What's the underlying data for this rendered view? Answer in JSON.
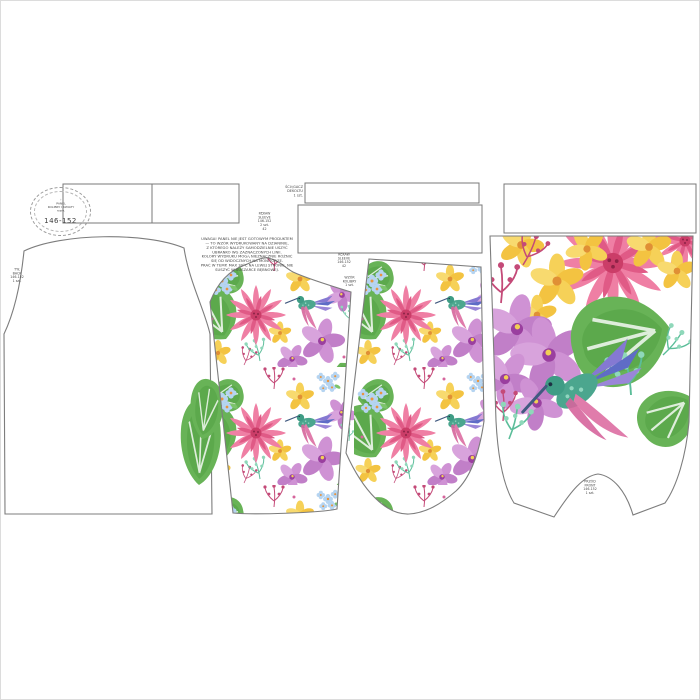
{
  "sheet": {
    "description": "sewing pattern panel sheet with hummingbird floral print",
    "size_label": "146-152"
  },
  "size_stamp": {
    "symbol": "◦",
    "lines": [
      "PANEL",
      "KOLIBRY I KWIATY",
      "rozm."
    ],
    "size": "146-152"
  },
  "annotations": {
    "neckband_note": {
      "lines": [
        "ŚCIĄGACZ",
        "DEKOLTU",
        "1 szt."
      ]
    },
    "sleeve_note": {
      "lines": [
        "RĘKAW",
        "SLEEVE",
        "146-152",
        "2 szt.",
        "42"
      ]
    },
    "care_note": {
      "lines": [
        "UWAGA! PANEL NIE JEST GOTOWYM PRODUKTEM — TO WZÓR WYDRUKOWANY NA DZIANINIE,",
        "Z KTÓREGO NALEŻY SAMODZIELNIE USZYĆ UBRANKO WG ZAZNACZONYCH LINII.",
        "KOLORY WYDRUKU MOGĄ NIEZNACZNIE RÓŻNIĆ SIĘ OD WIDOCZNYCH NA MONITORZE.",
        "PRAĆ W TEMP. MAX 30°C NA LEWEJ STRONIE, NIE SUSZYĆ W SUSZARCE BĘBNOWEJ."
      ]
    },
    "leg_note": {
      "lines": [
        "RĘKAW",
        "SLEEVE",
        "146-152",
        "42"
      ]
    },
    "piece_note": {
      "lines": [
        "WZÓR",
        "KOLIBRY",
        "1 szt."
      ]
    },
    "back_note": {
      "lines": [
        "TYŁ",
        "BACK",
        "146-152",
        "1 szt."
      ]
    },
    "front_note": {
      "lines": [
        "PRZÓD",
        "FRONT",
        "146-152",
        "1 szt."
      ]
    }
  },
  "colors": {
    "outline": "#787878",
    "dahlia_pink": "#ef7fa4",
    "dahlia_deep": "#cb3d68",
    "orchid_purple": "#cf92d4",
    "hydrangea_blue": "#b5d4f1",
    "flower_yellow": "#f6d158",
    "leaf_green": "#68b357",
    "bird_teal": "#4ba68e",
    "bird_tail_blue": "#5f6cc6",
    "wing_pink": "#e07cab",
    "mint": "#8fd8ba"
  }
}
